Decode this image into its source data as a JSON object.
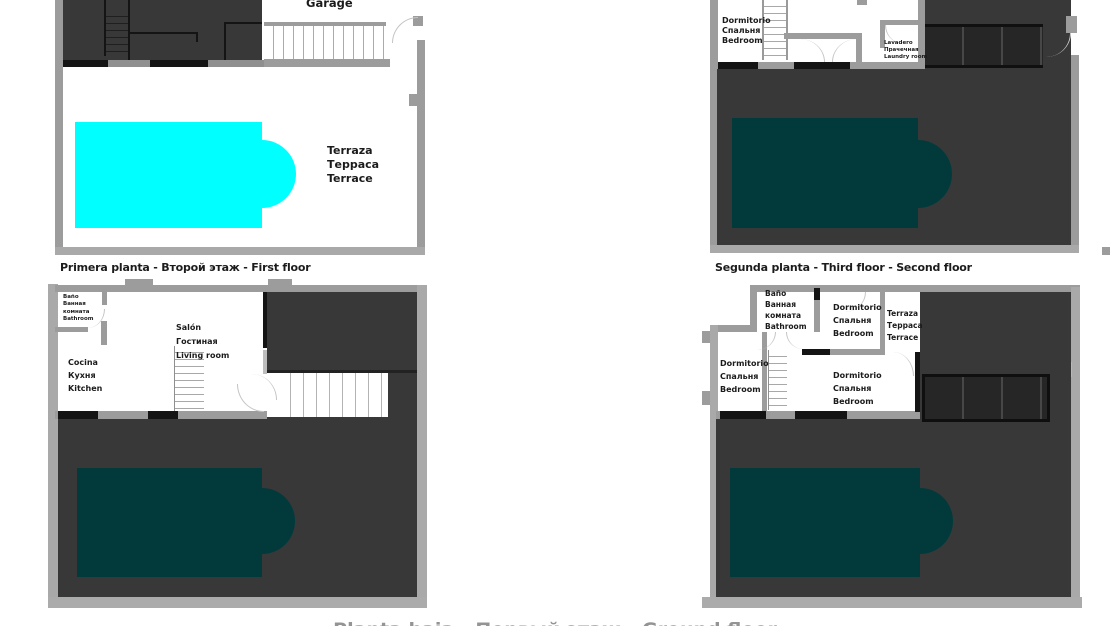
{
  "titles": {
    "bottom_left": "Primera planta - Второй этаж - First floor",
    "bottom_right": "Segunda planta - Third floor - Second floor",
    "bottom_cutoff": "Planta baja - Первый этаж - Ground floor"
  },
  "colors": {
    "pool_highlight": "#00ffff",
    "pool_dim": "#023a3c",
    "dark_area": "#383838",
    "wall": "#9c9c9c"
  },
  "plan_top_left": {
    "garage": "Garage",
    "terrace": [
      "Terraza",
      "Терраса",
      "Terrace"
    ]
  },
  "plan_top_right": {
    "bedroom": [
      "Dormitorio",
      "Спальня",
      "Bedroom"
    ],
    "laundry": [
      "Lavadero",
      "Прачечная",
      "Laundry room"
    ]
  },
  "plan_bottom_left": {
    "bathroom": [
      "Baño",
      "Ванная",
      "комната",
      "Bathroom"
    ],
    "living": [
      "Salón",
      "Гостиная",
      "Living room"
    ],
    "kitchen": [
      "Cocina",
      "Кухня",
      "Kitchen"
    ]
  },
  "plan_bottom_right": {
    "bathroom": [
      "Baño",
      "Ванная",
      "комната",
      "Bathroom"
    ],
    "bedroom_top": [
      "Dormitorio",
      "Спальня",
      "Bedroom"
    ],
    "terrace": [
      "Terraza",
      "Терраса",
      "Terrace"
    ],
    "bedroom_left": [
      "Dormitorio",
      "Спальня",
      "Bedroom"
    ],
    "bedroom_center": [
      "Dormitorio",
      "Спальня",
      "Bedroom"
    ]
  }
}
